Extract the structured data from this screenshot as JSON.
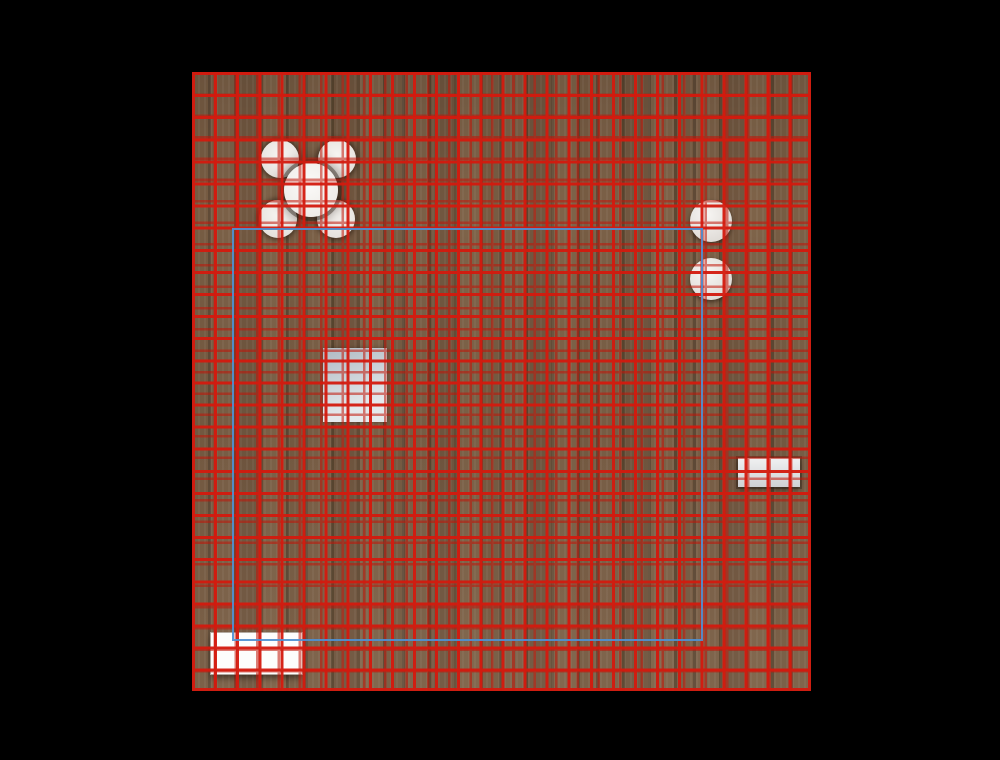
{
  "scene": {
    "description": "top-down floor-plan viewport with red layout grid and blue selection outline",
    "colors": {
      "background": "#000000",
      "wood_base": "#6e553f",
      "grid_red": "#d41a0e",
      "grid_red_secondary": "#c21508",
      "selection_blue": "#4e90d2",
      "counter_dark": "#30211b",
      "counter_frame": "#f3f0ea",
      "strip_white": "#fbfaf9",
      "desk_gray": "#aeb9c2"
    },
    "grid": {
      "spacing_primary_px": 22.1,
      "spacing_secondary_px": 21.35,
      "line_width_px": 3
    },
    "floor": {
      "x": 192,
      "y": 72,
      "w": 619,
      "h": 619
    },
    "objects": [
      {
        "name": "left-shade",
        "x": 0,
        "y": 0,
        "w": 46,
        "h": 619
      },
      {
        "name": "counter-shadow",
        "x": 248,
        "y": 86,
        "w": 280,
        "h": 150
      },
      {
        "name": "counter-frame",
        "x": 297,
        "y": 1,
        "w": 229,
        "h": 87
      },
      {
        "name": "counter-inner",
        "x": 302,
        "y": 6,
        "w": 219,
        "h": 75
      },
      {
        "name": "white-strip",
        "x": 526,
        "y": 0,
        "w": 93,
        "h": 382
      },
      {
        "name": "side-table-right",
        "x": 546,
        "y": 386,
        "w": 62,
        "h": 29
      },
      {
        "name": "stool-1",
        "x": 498,
        "y": 128,
        "w": 42,
        "h": 42
      },
      {
        "name": "stool-2",
        "x": 498,
        "y": 186,
        "w": 42,
        "h": 42
      },
      {
        "name": "chair-1",
        "x": 69,
        "y": 68,
        "w": 38,
        "h": 38
      },
      {
        "name": "chair-2",
        "x": 126,
        "y": 68,
        "w": 38,
        "h": 38
      },
      {
        "name": "chair-3",
        "x": 67,
        "y": 128,
        "w": 38,
        "h": 38
      },
      {
        "name": "chair-4",
        "x": 125,
        "y": 128,
        "w": 38,
        "h": 38
      },
      {
        "name": "dining-table",
        "x": 92,
        "y": 91,
        "w": 54,
        "h": 54
      },
      {
        "name": "table-post",
        "x": 115,
        "y": 114,
        "w": 9,
        "h": 9
      },
      {
        "name": "desk",
        "x": 131,
        "y": 276,
        "w": 64,
        "h": 74
      },
      {
        "name": "desk-bar",
        "x": 94,
        "y": 303,
        "w": 130,
        "h": 20
      },
      {
        "name": "bottom-left-table",
        "x": 19,
        "y": 561,
        "w": 91,
        "h": 41
      },
      {
        "name": "selection-rect",
        "x": 40,
        "y": 156,
        "w": 471,
        "h": 413
      }
    ]
  }
}
